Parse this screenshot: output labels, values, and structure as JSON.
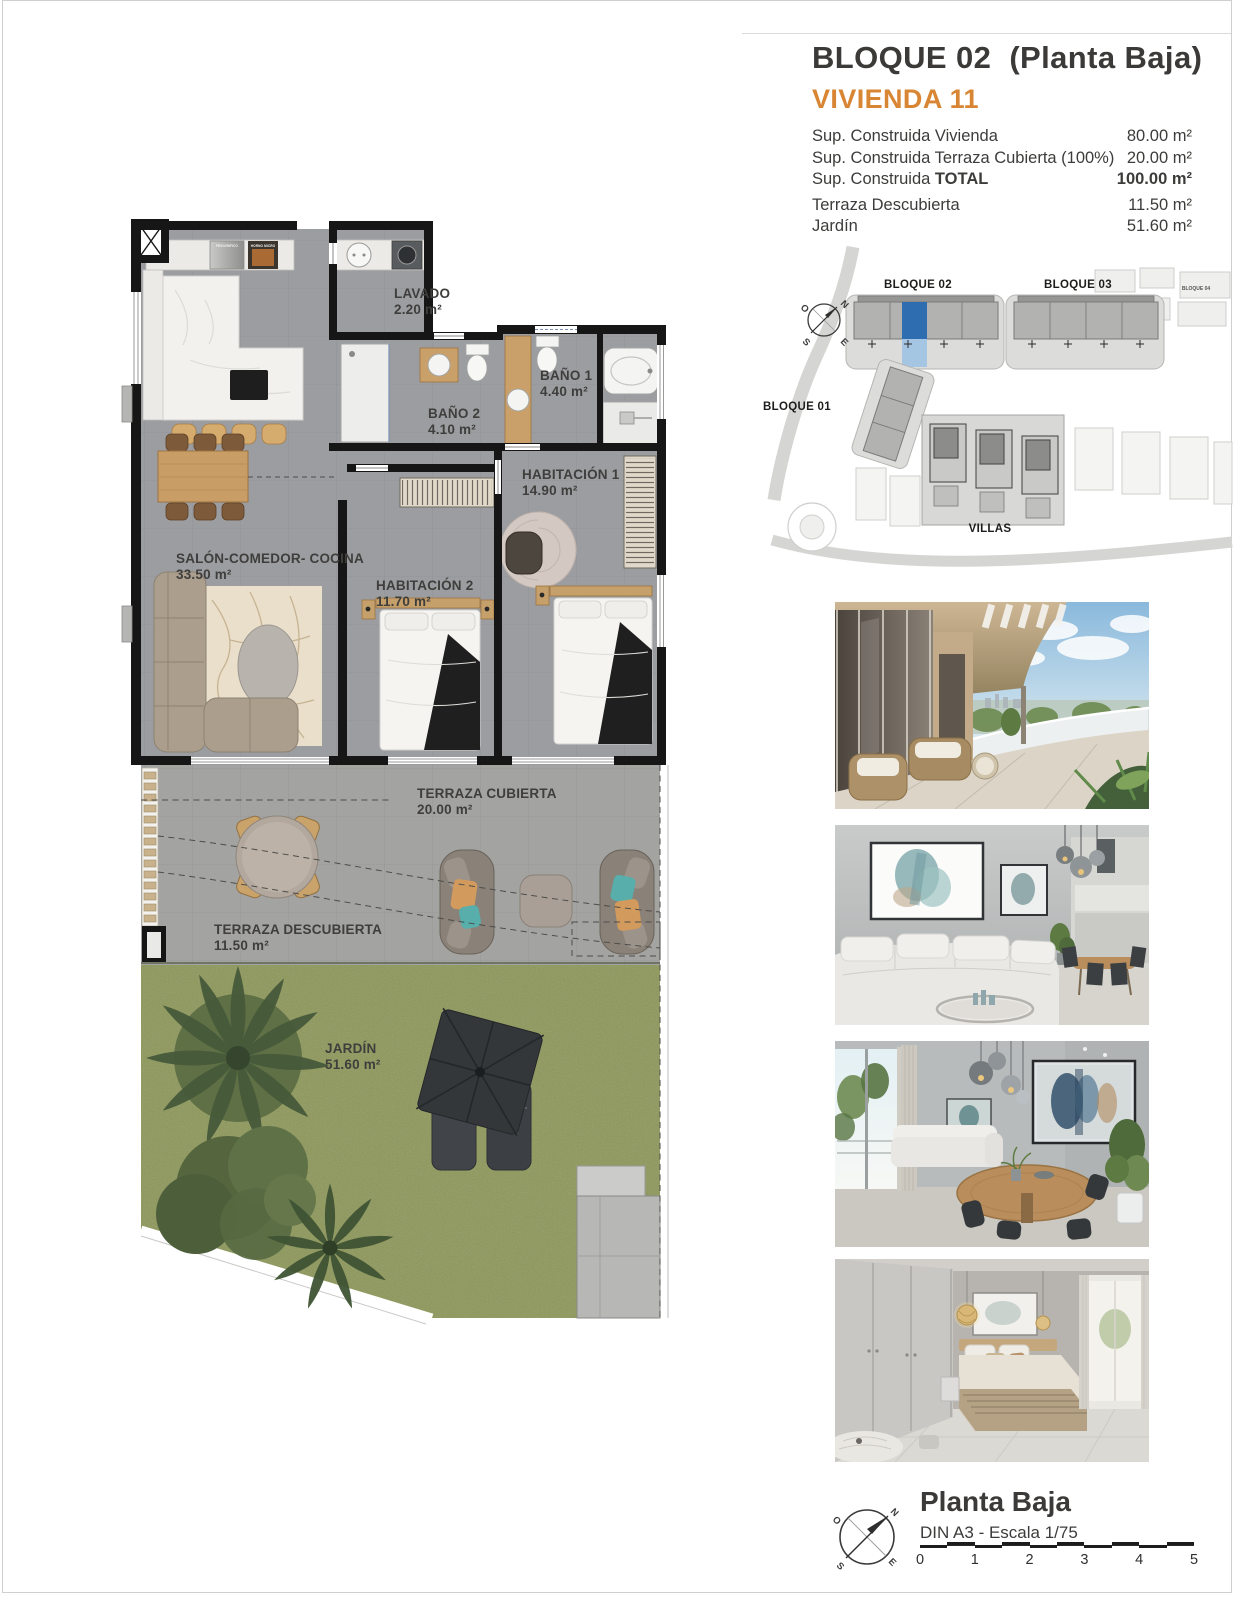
{
  "header": {
    "title": "BLOQUE 02  (Planta Baja)",
    "subtitle": "VIVIENDA 11",
    "areas": [
      {
        "label": "Sup. Construida Vivienda",
        "strong": "",
        "value": "80.00 m²"
      },
      {
        "label": "Sup. Construida Terraza Cubierta (100%)",
        "strong": "",
        "value": "20.00 m²"
      },
      {
        "label": "Sup. Construida ",
        "strong": "TOTAL",
        "value": "100.00 m²"
      },
      {
        "label": "Terraza Descubierta",
        "strong": "",
        "value": "11.50 m²"
      },
      {
        "label": "Jardín",
        "strong": "",
        "value": "51.60 m²"
      }
    ]
  },
  "site_plan": {
    "labels": {
      "bloque01": "BLOQUE 01",
      "bloque02": "BLOQUE 02",
      "bloque03": "BLOQUE 03",
      "bloque04": "BLOQUE 04",
      "villas": "VILLAS"
    },
    "highlight_color": "#2e6eb0",
    "highlight_light": "#a5c6e3"
  },
  "floor_plan": {
    "rooms": [
      {
        "name": "LAVADO",
        "area": "2.20 m²"
      },
      {
        "name": "BAÑO 2",
        "area": "4.10 m²"
      },
      {
        "name": "BAÑO 1",
        "area": "4.40 m²"
      },
      {
        "name": "HABITACIÓN 1",
        "area": "14.90 m²"
      },
      {
        "name": "HABITACIÓN 2",
        "area": "11.70 m²"
      },
      {
        "name": "SALÓN-COMEDOR- COCINA",
        "area": "33.50 m²"
      },
      {
        "name": "TERRAZA CUBIERTA",
        "area": "20.00 m²"
      },
      {
        "name": "TERRAZA DESCUBIERTA",
        "area": "11.50 m²"
      },
      {
        "name": "JARDÍN",
        "area": "51.60 m²"
      }
    ],
    "appliances": {
      "fridge": "FRIGORIFICO",
      "oven": "HORNO MICRO"
    }
  },
  "photos": [
    {
      "name": "covered-terrace-render"
    },
    {
      "name": "living-room-render"
    },
    {
      "name": "dining-area-render"
    },
    {
      "name": "bedroom-render"
    }
  ],
  "footer": {
    "plan_name": "Planta Baja",
    "sheet_info": "DIN A3 - Escala 1/75",
    "scale_ticks": [
      "0",
      "1",
      "2",
      "3",
      "4",
      "5"
    ]
  },
  "compass": {
    "n": "N",
    "e": "E",
    "s": "S",
    "o": "O"
  }
}
